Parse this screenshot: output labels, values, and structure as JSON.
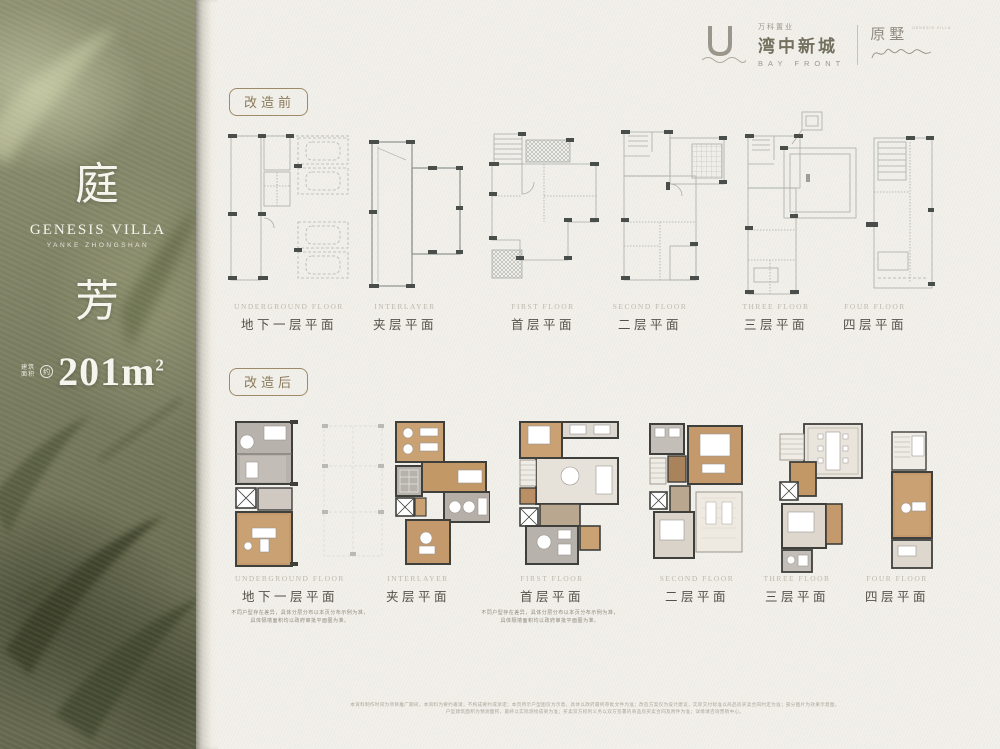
{
  "brand": {
    "dev_line": "万科置业",
    "project_name": "湾中新城",
    "project_en": "BAY FRONT",
    "sub_brand": "原墅",
    "sub_brand_note": "GENESIS VILLA"
  },
  "sidebar": {
    "title_top": "庭",
    "subtitle": "GENESIS VILLA",
    "subtitle_small": "YANKE ZHONGSHAN",
    "title_bottom": "芳",
    "area_label_1": "建筑",
    "area_label_2": "面积",
    "area_approx": "约",
    "area_value": "201m",
    "area_exp": "2"
  },
  "sections": {
    "before": "改造前",
    "after": "改造后"
  },
  "floors": [
    {
      "en": "UNDERGROUND FLOOR",
      "cn": "地下一层平面"
    },
    {
      "en": "INTERLAYER",
      "cn": "夹层平面"
    },
    {
      "en": "FIRST FLOOR",
      "cn": "首层平面"
    },
    {
      "en": "SECOND FLOOR",
      "cn": "二层平面"
    },
    {
      "en": "THREE FLOOR",
      "cn": "三层平面"
    },
    {
      "en": "FOUR FLOOR",
      "cn": "四层平面"
    }
  ],
  "notes": {
    "left_line1": "不同户型存在差异，具体分层分布以本页分布示例为准，",
    "left_line2": "具体隔墙面积均以政府审批平面图为准。",
    "right_line1": "不同户型存在差异，具体分层分布以本页分布示例为准，",
    "right_line2": "具体隔墙面积均以政府审批平面图为准。"
  },
  "footer": {
    "line1": "本资料制作时间为项目推广期间，本资料为要约邀请，不构成要约或承诺；本页所示户型图仅为示意，具体以政府最终审批文件为准；改造方案仅为设计建议，实际交付标准以商品房买卖合同约定为准；部分图片为效果示意图。",
    "line2": "户型建筑面积为预测面积，最终以实际测绘成果为准；买卖双方权利义务以双方签署的商品房买卖合同及附件为准；详情请咨询营销中心。"
  },
  "colors": {
    "accent_brown": "#8a7a5c",
    "wood": "#c49a6d",
    "tile_gray": "#b7b2ac",
    "wall": "#3f3f3c",
    "leaf_olive": "#6e7154",
    "paper": "#f2f0ea"
  }
}
